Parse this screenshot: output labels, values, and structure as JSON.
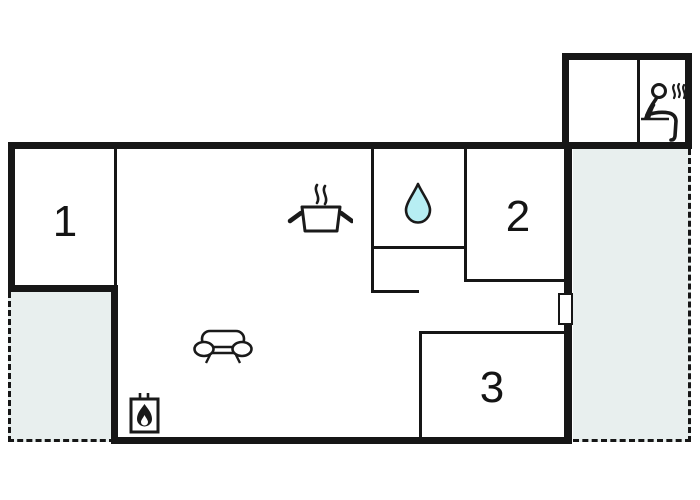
{
  "plan": {
    "type": "holiday-home floor plan",
    "colors": {
      "background": "#ffffff",
      "wall": "#161616",
      "terrace_fill": "#e8efee",
      "drop_fill": "#b7eef3",
      "icon_stroke": "#1a1a1a"
    },
    "rooms": [
      {
        "label": "1"
      },
      {
        "label": "2"
      },
      {
        "label": "3"
      }
    ],
    "icons": [
      {
        "name": "cooking-pot-icon"
      },
      {
        "name": "water-drop-icon"
      },
      {
        "name": "sofa-icon"
      },
      {
        "name": "wood-stove-icon"
      },
      {
        "name": "sauna-icon"
      }
    ],
    "features": {
      "terrace_count": 2,
      "door_marker_count": 1
    }
  }
}
